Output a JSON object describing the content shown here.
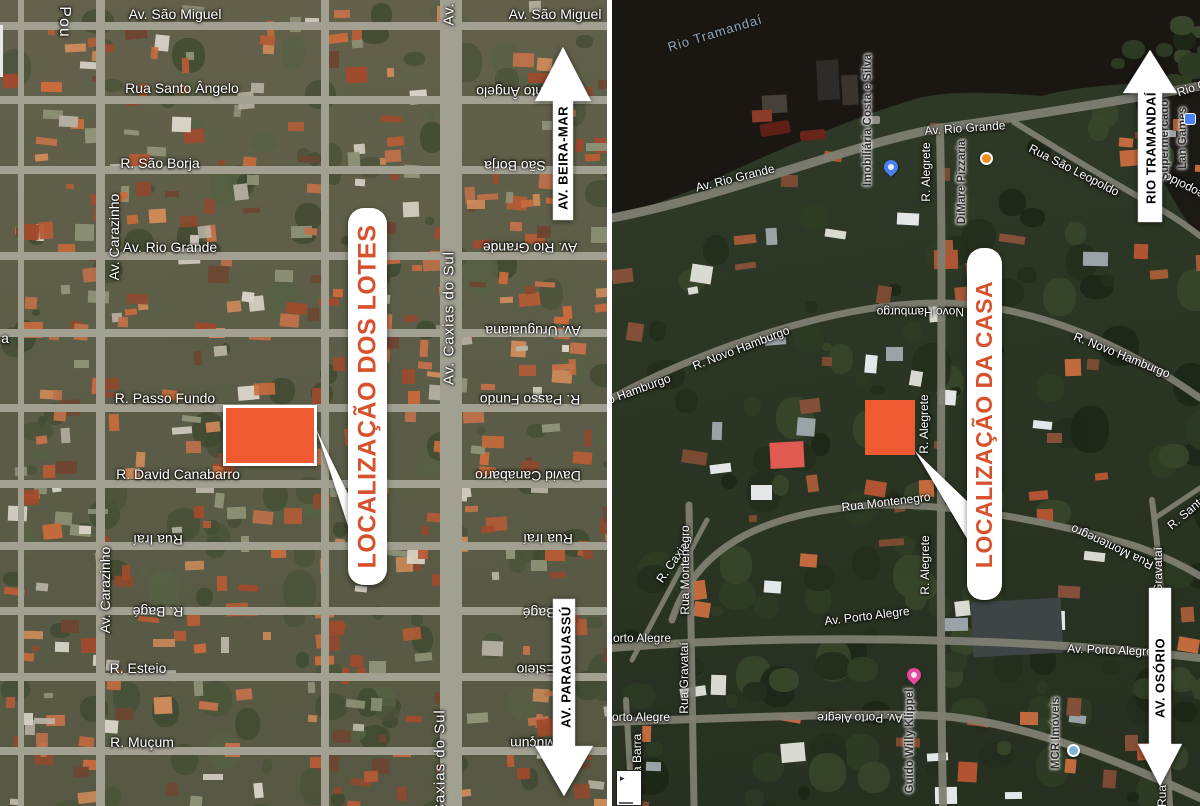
{
  "title": "Satellite location maps — lots and house",
  "colors": {
    "marker_orange": "#EF5A30",
    "callout_text": "#D8512D",
    "pill_bg": "#FFFFFF",
    "arrow_fill": "#FFFFFF",
    "arrow_text": "#111111",
    "street_text": "#FFFFFF",
    "poi_text": "#2F2F2F",
    "water": "#1A1713",
    "water_label": "#8FA7BD",
    "road_left": "#A2A091",
    "road_right": "#7E7E72",
    "divider": "#FFFFFF"
  },
  "left_panel": {
    "callout": {
      "text": "LOCALIZAÇÃO DOS LOTES"
    },
    "marker": {
      "shape": "rectangle",
      "x": 223,
      "y": 405,
      "w": 94,
      "h": 61
    },
    "tail_points": "316,429 352,502 352,538",
    "arrows": [
      {
        "id": "beira-mar",
        "label": "AV. BEIRA-MAR",
        "direction": "up",
        "cx": 563,
        "tip_y": 47,
        "head_y": 101,
        "end_y": 220,
        "half_head": 28,
        "half_shaft": 10,
        "label_cx": 563,
        "label_cy": 158
      },
      {
        "id": "paraguassu",
        "label": "AV. PARAGUASSÚ",
        "direction": "down",
        "cx": 564,
        "tip_y": 796,
        "head_y": 746,
        "end_y": 599,
        "half_head": 29,
        "half_shaft": 11,
        "label_cx": 566,
        "label_cy": 667
      }
    ],
    "roads": {
      "horizontal_y": [
        26,
        100,
        170,
        256,
        333,
        408,
        484,
        546,
        611,
        677,
        751
      ],
      "vertical_x": [
        21,
        100,
        325,
        451
      ],
      "vertical_w": [
        6,
        9,
        8,
        22
      ]
    },
    "streets": [
      {
        "t": "Av. São Miguel",
        "x": 175,
        "y": 14
      },
      {
        "t": "Av. São Miguel",
        "x": 555,
        "y": 14
      },
      {
        "t": "Rua Santo Ângelo",
        "x": 182,
        "y": 88
      },
      {
        "t": "R. São Borja",
        "x": 160,
        "y": 163
      },
      {
        "t": "Av. Rio Grande",
        "x": 170,
        "y": 247
      },
      {
        "t": "R. Passo Fundo",
        "x": 165,
        "y": 398
      },
      {
        "t": "R. David Canabarro",
        "x": 178,
        "y": 474
      },
      {
        "t": "Rua Iraí",
        "x": 158,
        "y": 540,
        "flip": 1
      },
      {
        "t": "R. Bagé",
        "x": 158,
        "y": 612,
        "flip": 1
      },
      {
        "t": "R. Esteio",
        "x": 138,
        "y": 668
      },
      {
        "t": "R. Muçum",
        "x": 142,
        "y": 742
      },
      {
        "t": "ua Santo Ângelo",
        "x": 528,
        "y": 92,
        "flip": 1
      },
      {
        "t": "São Borja",
        "x": 515,
        "y": 166,
        "flip": 1
      },
      {
        "t": "Av. Rio Grande",
        "x": 530,
        "y": 248,
        "flip": 1
      },
      {
        "t": "Av. Uruguaiana",
        "x": 533,
        "y": 331,
        "flip": 1
      },
      {
        "t": "R. Passo Fundo",
        "x": 530,
        "y": 400,
        "flip": 1
      },
      {
        "t": "David Canabarro",
        "x": 528,
        "y": 476,
        "flip": 1
      },
      {
        "t": "Rua Iraí",
        "x": 548,
        "y": 539,
        "flip": 1
      },
      {
        "t": "R. Bagé",
        "x": 548,
        "y": 613,
        "flip": 1
      },
      {
        "t": "R. Esteio",
        "x": 545,
        "y": 670,
        "flip": 1
      },
      {
        "t": "R. Muçum",
        "x": 542,
        "y": 744,
        "flip": 1
      },
      {
        "t": "Pou",
        "x": 64,
        "y": 22,
        "rot": 90,
        "size": 16
      },
      {
        "t": "Av. Carazinho",
        "x": 114,
        "y": 237,
        "rot": -90
      },
      {
        "t": "Av. Carazinho",
        "x": 105,
        "y": 590,
        "rot": -90
      },
      {
        "t": "Av.",
        "x": 449,
        "y": 14,
        "rot": -90,
        "size": 15
      },
      {
        "t": "Av. Caxias do Sul",
        "x": 449,
        "y": 318,
        "rot": -90,
        "size": 15
      },
      {
        "t": "Caxias do Sul",
        "x": 440,
        "y": 762,
        "rot": -90,
        "size": 15
      },
      {
        "t": "a",
        "x": 5,
        "y": 338
      }
    ]
  },
  "right_panel": {
    "callout": {
      "text": "LOCALIZAÇÃO DA CASA"
    },
    "marker": {
      "shape": "square",
      "x": 253,
      "y": 400,
      "w": 50,
      "h": 55
    },
    "tail_points": "303,451 357,503 357,542",
    "water_label": {
      "text": "Rio Tramandaí",
      "x": 103,
      "y": 33
    },
    "arrows": [
      {
        "id": "rio-tramandai",
        "label": "RIO TRAMANDAÍ",
        "direction": "up",
        "cx": 538,
        "tip_y": 50,
        "head_y": 93,
        "end_y": 222,
        "half_head": 27,
        "half_shaft": 12,
        "label_cx": 539,
        "label_cy": 148
      },
      {
        "id": "osorio",
        "label": "AV. OSÓRIO",
        "direction": "down",
        "cx": 548,
        "tip_y": 786,
        "head_y": 744,
        "end_y": 588,
        "half_head": 22,
        "half_shaft": 11,
        "label_cx": 548,
        "label_cy": 678
      }
    ],
    "streets": [
      {
        "t": "Av. Rio Grande",
        "x": 123,
        "y": 178,
        "rot": -14
      },
      {
        "t": "Av. Rio Grande",
        "x": 353,
        "y": 128,
        "rot": -4
      },
      {
        "t": "Rio G",
        "x": 580,
        "y": 88,
        "rot": -18
      },
      {
        "t": "Rua São Leopoldo",
        "x": 462,
        "y": 170,
        "rot": 27
      },
      {
        "t": "São Leopoldo",
        "x": 586,
        "y": 193,
        "rot": 207
      },
      {
        "t": "R. Alegrete",
        "x": 314,
        "y": 172,
        "rot": -90
      },
      {
        "t": "R. Alegrete",
        "x": 312,
        "y": 424,
        "rot": -90
      },
      {
        "t": "R. Alegrete",
        "x": 313,
        "y": 565,
        "rot": -90
      },
      {
        "t": "R. Novo Hamburgo",
        "x": 316,
        "y": 312,
        "rot": 180
      },
      {
        "t": "R. Novo Hamburgo",
        "x": 129,
        "y": 348,
        "rot": -21
      },
      {
        "t": "o Hamburgo",
        "x": 27,
        "y": 389,
        "rot": -20
      },
      {
        "t": "R. Novo Hamburgo",
        "x": 510,
        "y": 355,
        "rot": 22
      },
      {
        "t": "Rua Montenegro",
        "x": 274,
        "y": 502,
        "rot": -7
      },
      {
        "t": "Rua Montenegro",
        "x": 500,
        "y": 547,
        "rot": 205
      },
      {
        "t": "R. Santa",
        "x": 575,
        "y": 512,
        "rot": -40
      },
      {
        "t": "R. Caxias",
        "x": 62,
        "y": 560,
        "rot": -55
      },
      {
        "t": "Rua Montenegro",
        "x": 73,
        "y": 570,
        "rot": -90
      },
      {
        "t": "Rua Gravataí",
        "x": 72,
        "y": 678,
        "rot": -90
      },
      {
        "t": "anto da Barra",
        "x": 25,
        "y": 770,
        "rot": -90
      },
      {
        "t": "Av. Porto Alegre",
        "x": 255,
        "y": 616,
        "rot": -7
      },
      {
        "t": "orto Alegre",
        "x": 30,
        "y": 638
      },
      {
        "t": "Av. Porto Alegre",
        "x": 498,
        "y": 650,
        "rot": 2
      },
      {
        "t": "orto Alegre",
        "x": 29,
        "y": 717
      },
      {
        "t": "Av. Porto Alegre",
        "x": 248,
        "y": 718,
        "rot": 180
      },
      {
        "t": "Gravataí",
        "x": 546,
        "y": 570,
        "rot": -90
      },
      {
        "t": "Rua",
        "x": 550,
        "y": 796,
        "rot": -90
      }
    ],
    "pois": [
      {
        "name": "Imobiliária Costa e Silva",
        "x": 256,
        "y": 120,
        "icon": "pin",
        "icon_color": "#4A80F5",
        "icon_x": 272,
        "icon_y": 160
      },
      {
        "name": "DiMare Pizzaria",
        "x": 350,
        "y": 182,
        "icon": "circle",
        "icon_color": "#F08C1A",
        "icon_x": 368,
        "icon_y": 152
      },
      {
        "name": "Guido Willy Klippel",
        "x": 298,
        "y": 741,
        "icon": "pin",
        "icon_color": "#E5489A",
        "icon_x": 295,
        "icon_y": 668
      },
      {
        "name": "MCR Imóveis",
        "x": 444,
        "y": 733,
        "icon": "circle",
        "icon_color": "#7FB3D9",
        "icon_x": 455,
        "icon_y": 744
      },
      {
        "name": "Lan Games",
        "x": 571,
        "y": 138,
        "icon": "square",
        "icon_color": "#4A80F5",
        "icon_x": 572,
        "icon_y": 113
      },
      {
        "name": "Supermercado",
        "x": 553,
        "y": 140,
        "icon": "none"
      }
    ],
    "corner_box": {
      "glyph": "▸"
    }
  }
}
